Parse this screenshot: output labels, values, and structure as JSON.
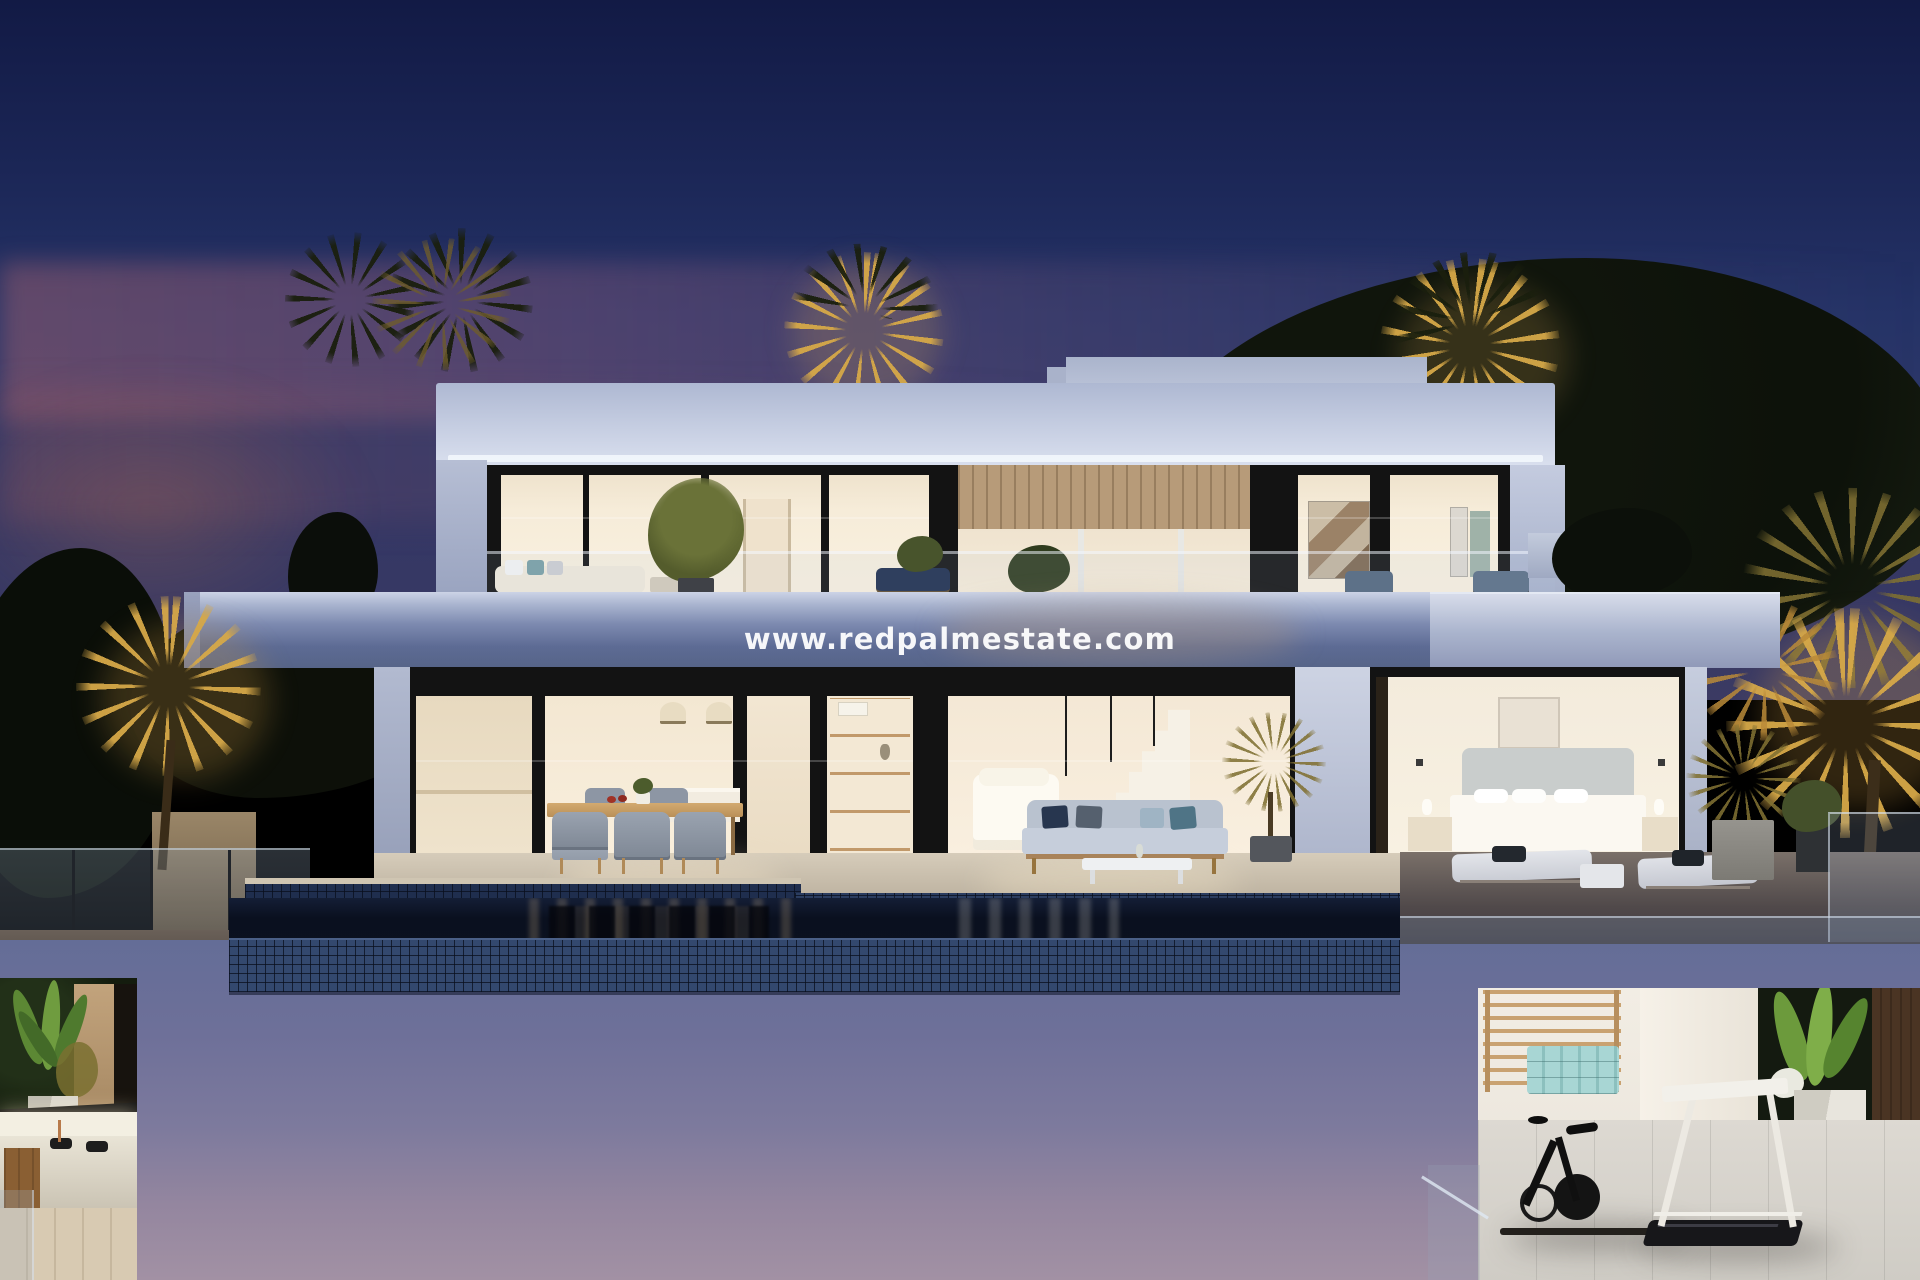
{
  "scene": {
    "description": "Modern two-storey white villa at dusk with infinity pool, lit interiors, palm trees and lower-level gym and spa",
    "time_of_day": "dusk"
  },
  "watermark": {
    "text": "www.redpalmestate.com",
    "color": "#ffffff"
  },
  "palette": {
    "sky_top": "#121a45",
    "sky_mid": "#263467",
    "sky_sunset_band": "#b06e78",
    "house_fascia": "#c6cee2",
    "slab_shadow": "#5d6b94",
    "window_frame": "#131313",
    "interior_warm": "#f6ecd9",
    "pool_tile": "#2b3d60",
    "pool_water": "#0a101f",
    "terrace_stone": "#c7bcaa",
    "basement_wall_top": "#646d97",
    "basement_wall_bottom": "#a291a4",
    "palm_gold": "#d6a848",
    "mat_mint": "#a8d6d4",
    "gym_floor": "#d5d2cb"
  },
  "objects": [
    "penthouse-roof-box",
    "upper-floor-windows",
    "upper-terrace-sofa",
    "upper-terrace-tree",
    "center-porch-wood-panel",
    "right-wing-windows-art",
    "balcony-slab",
    "ground-floor-kitchen",
    "outdoor-dining-set",
    "living-room-sofa",
    "interior-staircase",
    "outdoor-lounge-sofa",
    "coffee-table",
    "bedroom-bed",
    "sun-loungers",
    "side-table",
    "infinity-pool",
    "glass-railings",
    "spa-jacuzzi",
    "strelitzia-plants",
    "wall-bars",
    "mint-mat-rolls",
    "exercise-bike",
    "treadmill",
    "golden-palm-trees",
    "dark-vegetation"
  ]
}
